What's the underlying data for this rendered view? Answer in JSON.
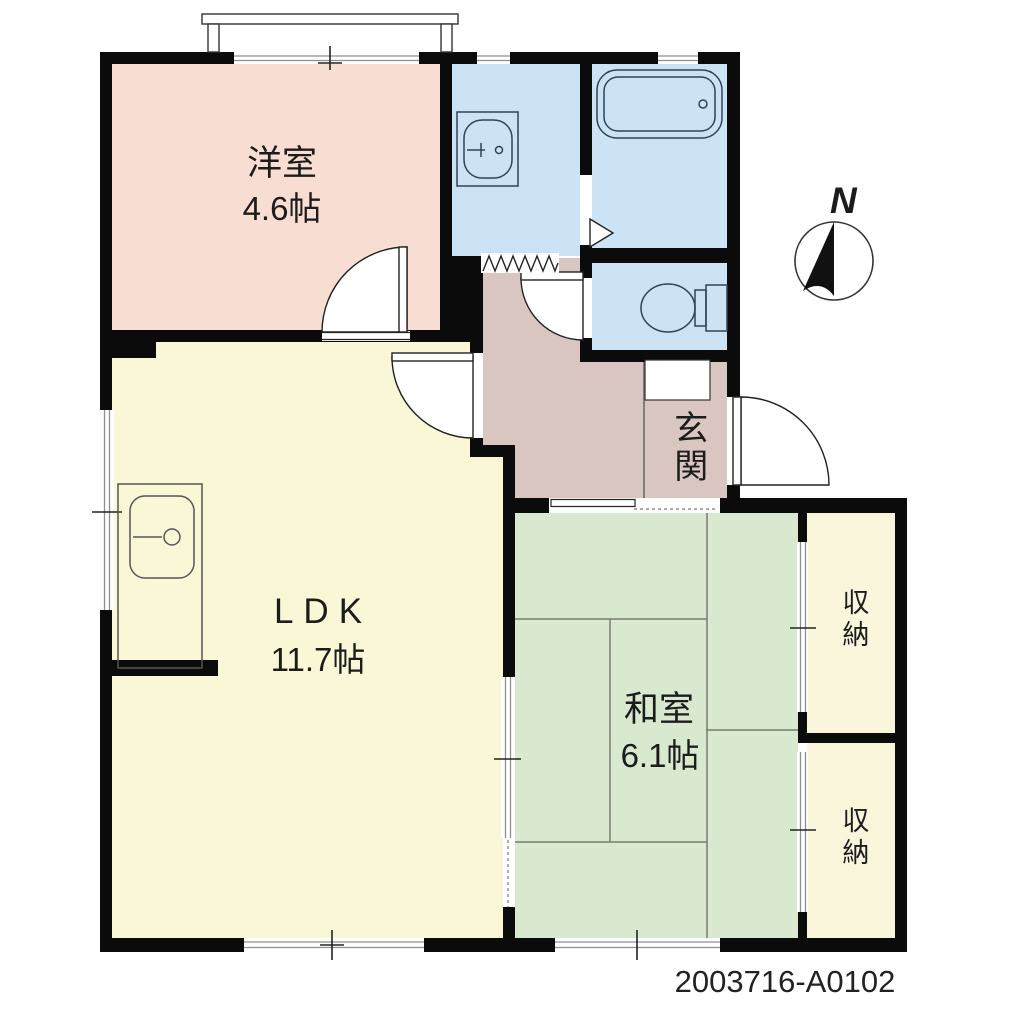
{
  "plan_id": "2003716-A0102",
  "compass": {
    "label": "N"
  },
  "rooms": {
    "yoshitsu": {
      "name": "洋室",
      "size": "4.6帖",
      "color": "#f8ddd2"
    },
    "ldk": {
      "name": "LDK",
      "size": "11.7帖",
      "color": "#f9f7d6"
    },
    "washitsu": {
      "name": "和室",
      "size": "6.1帖",
      "color": "#d8e9cf"
    },
    "genkan": {
      "name": "玄関",
      "color": "#d9c6c0"
    },
    "storage_top": {
      "name": "収納",
      "color": "#faf6dc"
    },
    "storage_bottom": {
      "name": "収納",
      "color": "#faf6dc"
    },
    "washroom": {
      "color": "#cbe3f5",
      "fixture": "washbasin"
    },
    "bathroom": {
      "color": "#cbe3f5",
      "fixture": "bathtub"
    },
    "toilet": {
      "color": "#cbe3f5",
      "fixture": "toilet"
    }
  },
  "colors": {
    "wall": "#0b0b0b",
    "line": "#222222",
    "fixture_line": "#31425a",
    "tatami_line": "#7a7a72",
    "window_line": "#8f8f8f",
    "text": "#1c1c1c"
  }
}
